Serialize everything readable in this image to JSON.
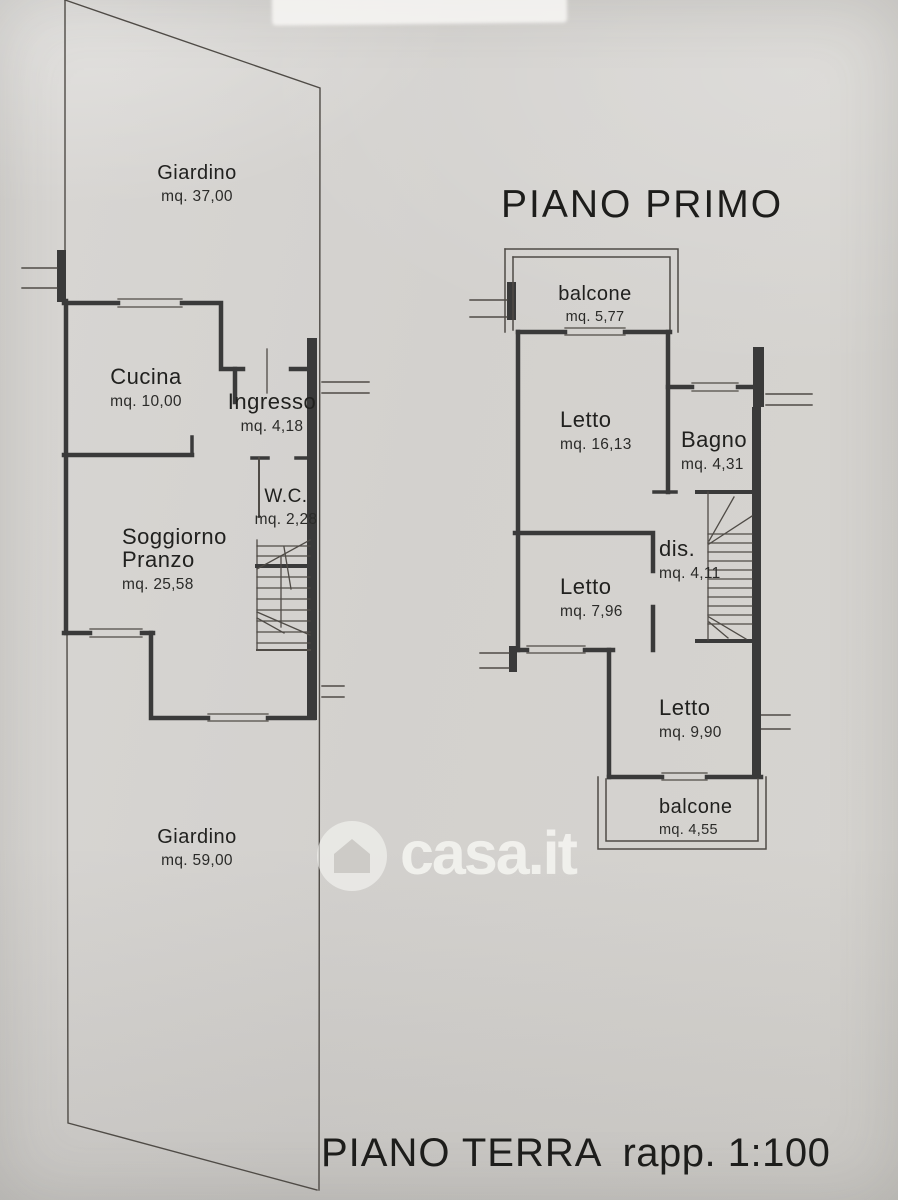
{
  "document": {
    "brand": "casa.it",
    "footer": {
      "title": "PIANO TERRA",
      "scale": "rapp. 1:100"
    }
  },
  "floors": [
    {
      "name": "PIANO TERRA",
      "rooms": [
        {
          "label": "Giardino",
          "area": "mq. 37,00"
        },
        {
          "label": "Cucina",
          "area": "mq. 10,00"
        },
        {
          "label": "Ingresso",
          "area": "mq. 4,18"
        },
        {
          "label": "W.C.",
          "area": "mq. 2,28"
        },
        {
          "label": "Soggiorno",
          "label2": "Pranzo",
          "area": "mq. 25,58"
        },
        {
          "label": "Giardino",
          "area": "mq. 59,00"
        }
      ]
    },
    {
      "name": "PIANO PRIMO",
      "rooms": [
        {
          "label": "balcone",
          "area": "mq. 5,77"
        },
        {
          "label": "Letto",
          "area": "mq. 16,13"
        },
        {
          "label": "Bagno",
          "area": "mq. 4,31"
        },
        {
          "label": "dis.",
          "area": "mq. 4,11"
        },
        {
          "label": "Letto",
          "area": "mq. 7,96"
        },
        {
          "label": "Letto",
          "area": "mq. 9,90"
        },
        {
          "label": "balcone",
          "area": "mq. 4,55"
        }
      ]
    }
  ]
}
